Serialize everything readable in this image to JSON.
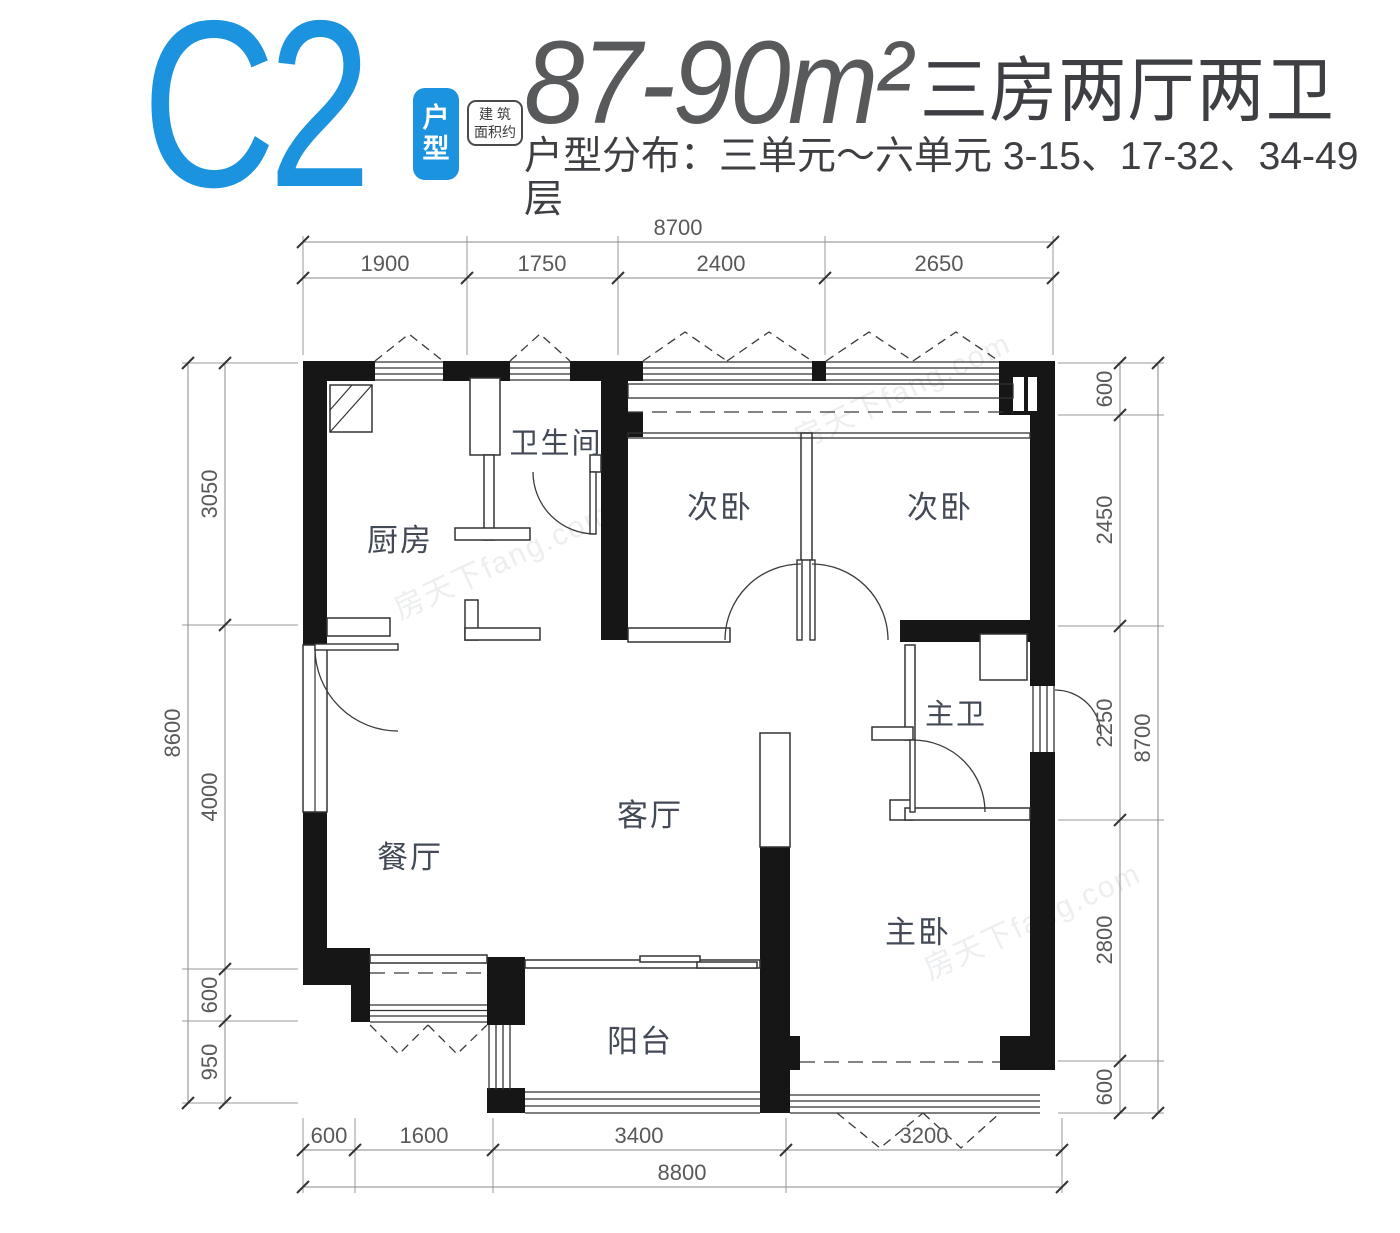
{
  "header": {
    "unit_code": "C2",
    "unit_badge": "户型",
    "area_note_line1": "建 筑",
    "area_note_line2": "面积约",
    "area_range": "87-90m²",
    "layout_type": "三房两厅两卫",
    "distribution": "户型分布：三单元～六单元 3-15、17-32、34-49 层"
  },
  "rooms": {
    "kitchen": "厨房",
    "bathroom": "卫生间",
    "bedroom_a": "次卧",
    "bedroom_b": "次卧",
    "master_bathroom": "主卫",
    "living_room": "客厅",
    "dining_room": "餐厅",
    "master_bedroom": "主卧",
    "balcony": "阳台"
  },
  "dimensions": {
    "top": {
      "overall": "8700",
      "segments": [
        "1900",
        "1750",
        "2400",
        "2650"
      ]
    },
    "bottom": {
      "overall": "8800",
      "segments": [
        "600",
        "1600",
        "3400",
        "3200"
      ]
    },
    "left": {
      "overall": "8600",
      "segments": [
        "3050",
        "4000",
        "600",
        "950"
      ]
    },
    "right": {
      "overall": "8700",
      "segments": [
        "600",
        "2450",
        "2250",
        "2800",
        "600"
      ]
    }
  },
  "colors": {
    "accent_blue": "#1b93de",
    "wall_black": "#161616",
    "dim_gray": "#58595b"
  },
  "watermark": "房天下fang.com"
}
